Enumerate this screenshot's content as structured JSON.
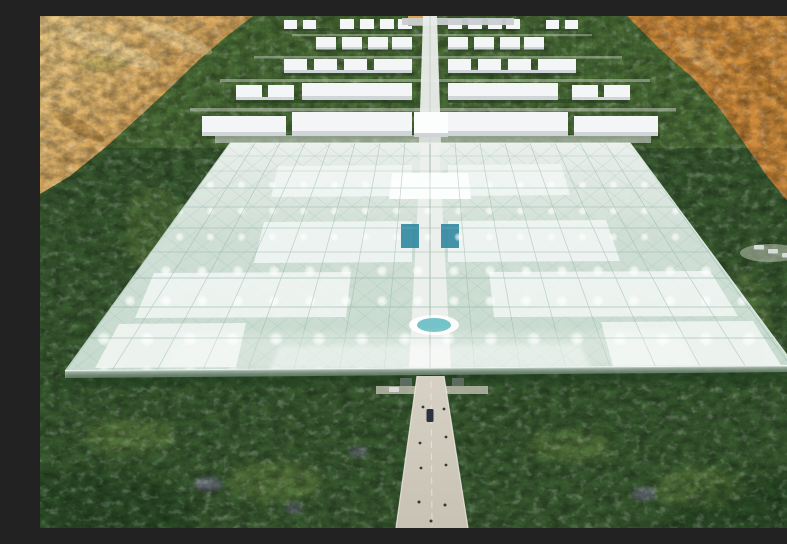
{
  "scene": {
    "title": "Aerial 3D rendering of a vast glass greenhouse complex with mirrored rows of white farm buildings, set in a green palm-oasis forest surrounded by desert sand, with a central road leading to the entrance",
    "type": "architectural-render",
    "visible_text": "none"
  },
  "colors": {
    "forest-base": "#3a5c31",
    "forest-top": "#5c813e",
    "forest-light": "#8fae54",
    "forest-shadow": "#1f3a1e",
    "desert-left-light": "#eccb85",
    "desert-left-deep": "#d09445",
    "desert-right-light": "#dc9c49",
    "desert-right-deep": "#c57e2f",
    "desert-shadow": "#96621f",
    "desert-highlight": "#f2dba2",
    "glass-top": "#f0f5f2",
    "glass-mid": "#dbe9e2",
    "glass-low": "#cfe2d7",
    "glass-line": "#8fb3a6",
    "glass-wall": "#b9c9bf",
    "panel-white": "#f3f7f5",
    "panel-bright": "#fcfefd",
    "building-roof": "#f3f5f6",
    "building-face": "#cfd5d8",
    "spine": "#e9ece9",
    "road": "#d6d1c4",
    "road-low": "#c7c2b4",
    "road-line": "#efece4",
    "pond": "#74c3c8",
    "teal-box": "#2f87a2",
    "car-dark": "#2b3340",
    "car-light": "#d8dbdd",
    "person": "#26282a",
    "violet-tree": "#8678a8"
  },
  "greenhouse": {
    "shape": "perspective trapezoid",
    "grid_columns": 16,
    "grid_rows": 10,
    "white_diffuser_panel_pairs": 4,
    "central_spine": true,
    "center_pond": true,
    "teal_service_blocks": 2,
    "light_dots": "grid of glowing roof lights, larger toward front"
  },
  "campus": {
    "building_rows": 5,
    "arrangement": "mirrored about central axis, small sheds far, long warehouses near",
    "access_roads": 4
  },
  "road": {
    "orientation": "vertical from bottom center to horizon",
    "dark_vehicles": 1,
    "light_vehicles": 1,
    "pedestrians": 9,
    "parked_cars_right_clearing": 3
  },
  "landscape": {
    "desert_corners": [
      "top-left",
      "top-right"
    ],
    "forest": "dense palm oasis",
    "accent_trees": "violet canopies scattered in lower forest"
  }
}
